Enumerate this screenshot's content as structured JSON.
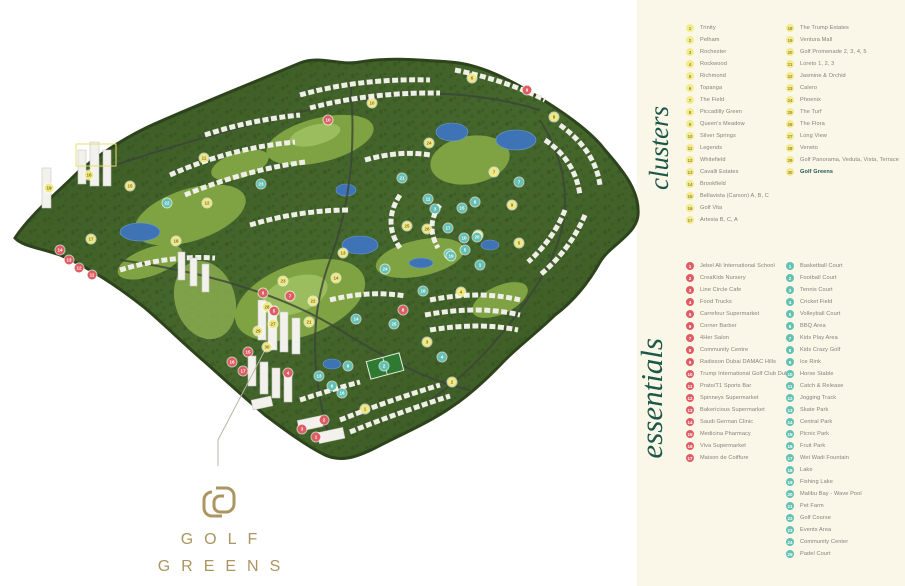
{
  "brand": {
    "line1": "GOLF",
    "line2": "GREENS",
    "monogram": "golf-greens-monogram"
  },
  "clusters": {
    "label": "clusters",
    "col1": [
      "Trinity",
      "Pelham",
      "Rochester",
      "Rockwood",
      "Richmond",
      "Topanga",
      "The Field",
      "Piccadilly Green",
      "Queen's Meadow",
      "Silver Springs",
      "Legends",
      "Whitefield",
      "Cavalli Estates",
      "Brookfield",
      "Bellavista (Carson) A, B, C",
      "Golf Vita",
      "Artesia B, C, A"
    ],
    "col2": [
      "The Trump Estates",
      "Ventura Mall",
      "Golf Promenade 2, 3, 4, 5",
      "Loreto 1, 2, 3",
      "Jasmine & Orchid",
      "Calero",
      "Phoenix",
      "The Turf",
      "The Flora",
      "Long View",
      "Veneto",
      "Golf Panorama, Veduta, Vista, Terrace",
      "Golf Greens"
    ],
    "highlight_number": 30
  },
  "essentials": {
    "label": "essentials",
    "services": [
      "Jebel Ali International School",
      "CreaKids Nursery",
      "Line Circle Cafe",
      "Food Trucks",
      "Carrefour Supermarket",
      "Corner Barber",
      "4Her Salon",
      "Community Centre",
      "Radisson Dubai DAMAC Hills",
      "Trump International Golf Club Dubai",
      "Prato/T1 Sports Bar",
      "Spinneys Supermarket",
      "Bakericious Supermarket",
      "Saudi German Clinic",
      "Medicina Pharmacy",
      "Viva Supermarket",
      "Maison de Coiffure"
    ],
    "amenities": [
      "Basketball Court",
      "Football Court",
      "Tennis Court",
      "Cricket Field",
      "Volleyball Court",
      "BBQ Area",
      "Kids Play Area",
      "Kids Crazy Golf",
      "Ice Rink",
      "Horse Stable",
      "Catch & Release",
      "Jogging Track",
      "Skate Park",
      "Central Park",
      "Picnic Park",
      "Fruit Park",
      "Wet Wadi Fountain",
      "Lake",
      "Fishing Lake",
      "Malibu Bay - Wave Pool",
      "Pet Farm",
      "Golf Course",
      "Events Area",
      "Community Center",
      "Padel Court"
    ]
  },
  "colors": {
    "cluster_marker": "#f1e983",
    "service_marker": "#e05c63",
    "amenity_marker": "#62c1b4",
    "label_green": "#1c574a",
    "brand_gold": "#ab9560",
    "panel_cream": "#faf7e8"
  },
  "map": {
    "markers": [
      {
        "t": "cluster",
        "n": 1,
        "x": 365,
        "y": 409
      },
      {
        "t": "cluster",
        "n": 2,
        "x": 452,
        "y": 382
      },
      {
        "t": "cluster",
        "n": 3,
        "x": 427,
        "y": 342
      },
      {
        "t": "cluster",
        "n": 4,
        "x": 461,
        "y": 292
      },
      {
        "t": "cluster",
        "n": 5,
        "x": 519,
        "y": 243
      },
      {
        "t": "cluster",
        "n": 6,
        "x": 472,
        "y": 78
      },
      {
        "t": "cluster",
        "n": 7,
        "x": 494,
        "y": 172
      },
      {
        "t": "cluster",
        "n": 8,
        "x": 554,
        "y": 117
      },
      {
        "t": "cluster",
        "n": 9,
        "x": 512,
        "y": 205
      },
      {
        "t": "cluster",
        "n": 10,
        "x": 372,
        "y": 103
      },
      {
        "t": "cluster",
        "n": 11,
        "x": 204,
        "y": 158
      },
      {
        "t": "cluster",
        "n": 12,
        "x": 207,
        "y": 203
      },
      {
        "t": "cluster",
        "n": 13,
        "x": 343,
        "y": 253
      },
      {
        "t": "cluster",
        "n": 14,
        "x": 336,
        "y": 278
      },
      {
        "t": "cluster",
        "n": 15,
        "x": 130,
        "y": 186
      },
      {
        "t": "cluster",
        "n": 16,
        "x": 89,
        "y": 175
      },
      {
        "t": "cluster",
        "n": 17,
        "x": 91,
        "y": 239
      },
      {
        "t": "cluster",
        "n": 18,
        "x": 176,
        "y": 241
      },
      {
        "t": "cluster",
        "n": 19,
        "x": 49,
        "y": 188
      },
      {
        "t": "cluster",
        "n": 20,
        "x": 478,
        "y": 235
      },
      {
        "t": "cluster",
        "n": 21,
        "x": 309,
        "y": 322
      },
      {
        "t": "cluster",
        "n": 22,
        "x": 313,
        "y": 301
      },
      {
        "t": "cluster",
        "n": 23,
        "x": 283,
        "y": 281
      },
      {
        "t": "cluster",
        "n": 24,
        "x": 429,
        "y": 143
      },
      {
        "t": "cluster",
        "n": 25,
        "x": 407,
        "y": 226
      },
      {
        "t": "cluster",
        "n": 26,
        "x": 427,
        "y": 229
      },
      {
        "t": "cluster",
        "n": 27,
        "x": 273,
        "y": 324
      },
      {
        "t": "cluster",
        "n": 28,
        "x": 267,
        "y": 307
      },
      {
        "t": "cluster",
        "n": 29,
        "x": 258,
        "y": 331
      },
      {
        "t": "cluster",
        "n": 30,
        "x": 267,
        "y": 347
      },
      {
        "t": "service",
        "n": 1,
        "x": 316,
        "y": 437
      },
      {
        "t": "service",
        "n": 2,
        "x": 324,
        "y": 420
      },
      {
        "t": "service",
        "n": 3,
        "x": 302,
        "y": 429
      },
      {
        "t": "service",
        "n": 4,
        "x": 288,
        "y": 373
      },
      {
        "t": "service",
        "n": 5,
        "x": 274,
        "y": 311
      },
      {
        "t": "service",
        "n": 6,
        "x": 263,
        "y": 293
      },
      {
        "t": "service",
        "n": 7,
        "x": 290,
        "y": 296
      },
      {
        "t": "service",
        "n": 8,
        "x": 403,
        "y": 310
      },
      {
        "t": "service",
        "n": 9,
        "x": 527,
        "y": 90
      },
      {
        "t": "service",
        "n": 10,
        "x": 328,
        "y": 120
      },
      {
        "t": "service",
        "n": 11,
        "x": 92,
        "y": 275
      },
      {
        "t": "service",
        "n": 12,
        "x": 79,
        "y": 268
      },
      {
        "t": "service",
        "n": 13,
        "x": 69,
        "y": 260
      },
      {
        "t": "service",
        "n": 14,
        "x": 60,
        "y": 250
      },
      {
        "t": "service",
        "n": 15,
        "x": 248,
        "y": 352
      },
      {
        "t": "service",
        "n": 16,
        "x": 232,
        "y": 362
      },
      {
        "t": "service",
        "n": 17,
        "x": 243,
        "y": 371
      },
      {
        "t": "amenity",
        "n": 1,
        "x": 480,
        "y": 265
      },
      {
        "t": "amenity",
        "n": 2,
        "x": 384,
        "y": 366
      },
      {
        "t": "amenity",
        "n": 3,
        "x": 435,
        "y": 209
      },
      {
        "t": "amenity",
        "n": 4,
        "x": 442,
        "y": 357
      },
      {
        "t": "amenity",
        "n": 5,
        "x": 465,
        "y": 250
      },
      {
        "t": "amenity",
        "n": 6,
        "x": 332,
        "y": 386
      },
      {
        "t": "amenity",
        "n": 7,
        "x": 519,
        "y": 182
      },
      {
        "t": "amenity",
        "n": 8,
        "x": 475,
        "y": 202
      },
      {
        "t": "amenity",
        "n": 9,
        "x": 348,
        "y": 366
      },
      {
        "t": "amenity",
        "n": 10,
        "x": 464,
        "y": 238
      },
      {
        "t": "amenity",
        "n": 11,
        "x": 428,
        "y": 199
      },
      {
        "t": "amenity",
        "n": 12,
        "x": 449,
        "y": 254
      },
      {
        "t": "amenity",
        "n": 13,
        "x": 319,
        "y": 376
      },
      {
        "t": "amenity",
        "n": 14,
        "x": 356,
        "y": 319
      },
      {
        "t": "amenity",
        "n": 15,
        "x": 462,
        "y": 208
      },
      {
        "t": "amenity",
        "n": 16,
        "x": 342,
        "y": 393
      },
      {
        "t": "amenity",
        "n": 17,
        "x": 448,
        "y": 228
      },
      {
        "t": "amenity",
        "n": 18,
        "x": 423,
        "y": 291
      },
      {
        "t": "amenity",
        "n": 19,
        "x": 451,
        "y": 256
      },
      {
        "t": "amenity",
        "n": 20,
        "x": 477,
        "y": 237
      },
      {
        "t": "amenity",
        "n": 21,
        "x": 402,
        "y": 178
      },
      {
        "t": "amenity",
        "n": 22,
        "x": 167,
        "y": 203
      },
      {
        "t": "amenity",
        "n": 23,
        "x": 261,
        "y": 184
      },
      {
        "t": "amenity",
        "n": 24,
        "x": 385,
        "y": 269
      },
      {
        "t": "amenity",
        "n": 25,
        "x": 394,
        "y": 324
      }
    ]
  }
}
